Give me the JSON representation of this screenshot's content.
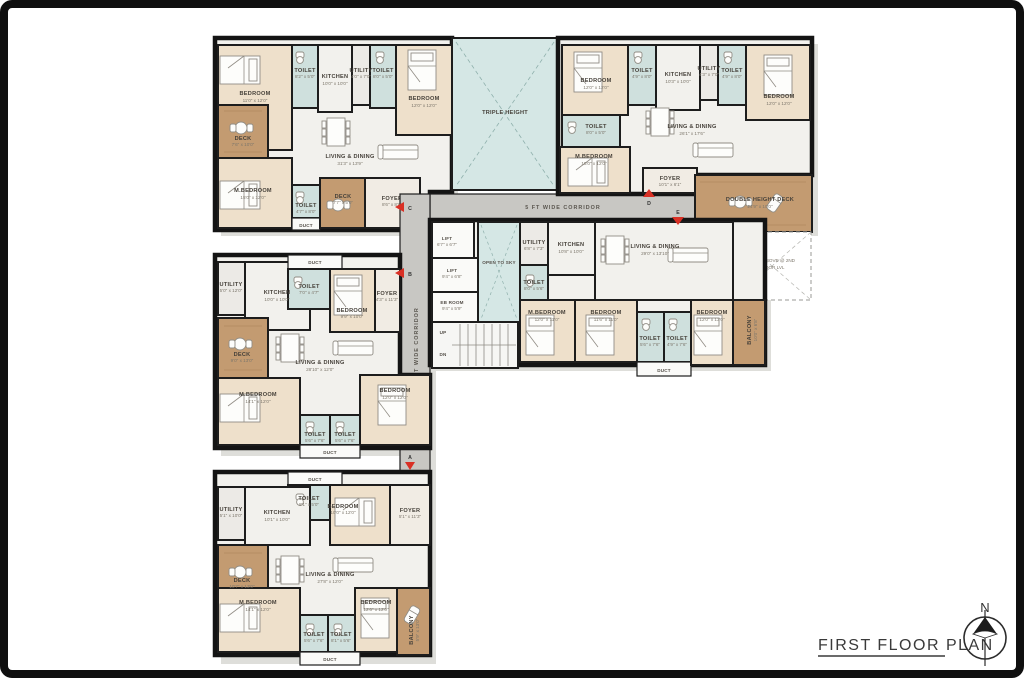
{
  "footer": {
    "title": "FIRST FLOOR PLAN",
    "north": "N"
  },
  "markers": {
    "a": "A",
    "b": "B",
    "c": "C",
    "d": "D",
    "e": "E"
  },
  "core": {
    "corridor": "5 FT WIDE CORRIDOR",
    "triple_height": "TRIPLE HEIGHT",
    "open_to_sky": "OPEN TO SKY",
    "up": "UP",
    "dn": "DN",
    "lift1": {
      "n": "LIFT",
      "d": "6'7\" x 6'7\""
    },
    "lift2": {
      "n": "LIFT",
      "d": "9'4\" x 6'8\""
    },
    "eb": {
      "n": "EB ROOM",
      "d": "9'4\" x 5'9\""
    }
  },
  "units": {
    "a": {
      "rooms": {
        "b1": {
          "n": "BEDROOM",
          "d": "11'0\" x 12'0\""
        },
        "t1": {
          "n": "TOILET",
          "d": "8'2\" x 5'0\""
        },
        "k": {
          "n": "KITCHEN",
          "d": "10'0\" x 10'0\""
        },
        "u": {
          "n": "UTILITY",
          "d": "4'0\" x 7'0\""
        },
        "t2": {
          "n": "TOILET",
          "d": "8'0\" x 5'0\""
        },
        "b2": {
          "n": "BEDROOM",
          "d": "12'0\" x 12'0\""
        },
        "dk": {
          "n": "DECK",
          "d": "7'6\" x 10'0\""
        },
        "lv": {
          "n": "LIVING & DINING",
          "d": "31'3\" x 13'9\""
        },
        "mb": {
          "n": "M.BEDROOM",
          "d": "15'0\" x 12'0\""
        },
        "t3": {
          "n": "TOILET",
          "d": "4'7\" x 8'0\""
        },
        "du": {
          "n": "DUCT"
        },
        "dk2": {
          "n": "DECK",
          "d": "7'7\" x 5'0\""
        },
        "fy": {
          "n": "FOYER",
          "d": "8'6\" x 8'6\""
        }
      }
    },
    "b": {
      "rooms": {
        "b1": {
          "n": "BEDROOM",
          "d": "12'0\" x 12'0\""
        },
        "t1": {
          "n": "TOILET",
          "d": "4'9\" x 8'0\""
        },
        "k": {
          "n": "KITCHEN",
          "d": "10'3\" x 10'0\""
        },
        "u": {
          "n": "UTILITY",
          "d": "4'3\" x 7'0\""
        },
        "t2": {
          "n": "TOILET",
          "d": "4'9\" x 8'0\""
        },
        "b2": {
          "n": "BEDROOM",
          "d": "12'0\" x 12'0\""
        },
        "t3": {
          "n": "TOILET",
          "d": "8'0\" x 5'0\""
        },
        "mb": {
          "n": "M.BEDROOM",
          "d": "15'0\" x 12'0\""
        },
        "lv": {
          "n": "LIVING & DINING",
          "d": "26'1\" x 17'6\""
        },
        "fy": {
          "n": "FOYER",
          "d": "10'1\" x 6'1\""
        },
        "dhd": {
          "n": "DOUBLE HEIGHT DECK",
          "d": "24'9\" x 10'0\""
        },
        "da_l1": "DECK ABOVE @ 2ND",
        "da_l2": "FLOOR LVL"
      }
    },
    "c": {
      "rooms": {
        "u": {
          "n": "UTILITY",
          "d": "6'8\" x 7'3\""
        },
        "k": {
          "n": "KITCHEN",
          "d": "10'8\" x 10'0\""
        },
        "t1": {
          "n": "TOILET",
          "d": "8'0\" x 5'6\""
        },
        "lv": {
          "n": "LIVING & DINING",
          "d": "29'0\" x 13'10\""
        },
        "mb": {
          "n": "M.BEDROOM",
          "d": "12'0\" x 11'0\""
        },
        "b1": {
          "n": "BEDROOM",
          "d": "11'6\" x 11'0\""
        },
        "t2": {
          "n": "TOILET",
          "d": "5'6\" x 7'6\""
        },
        "t3": {
          "n": "TOILET",
          "d": "4'9\" x 7'6\""
        },
        "du": {
          "n": "DUCT"
        },
        "b2": {
          "n": "BEDROOM",
          "d": "12'0\" x 13'0\""
        },
        "bal": {
          "n": "BALCONY",
          "d": "10'0\" x 6'8\""
        }
      }
    },
    "d": {
      "rooms": {
        "u": {
          "n": "UTILITY",
          "d": "5'0\" x 12'0\""
        },
        "k": {
          "n": "KITCHEN",
          "d": "10'0\" x 10'0\""
        },
        "du1": {
          "n": "DUCT"
        },
        "t1": {
          "n": "TOILET",
          "d": "7'0\" x 4'7\""
        },
        "b1": {
          "n": "BEDROOM",
          "d": "9'9\" x 10'0\""
        },
        "fy": {
          "n": "FOYER",
          "d": "4'3\" x 11'3\""
        },
        "dk": {
          "n": "DECK",
          "d": "9'0\" x 13'0\""
        },
        "lv": {
          "n": "LIVING & DINING",
          "d": "28'10\" x 12'0\""
        },
        "mb": {
          "n": "M.BEDROOM",
          "d": "14'1\" x 12'0\""
        },
        "t2": {
          "n": "TOILET",
          "d": "5'6\" x 7'6\""
        },
        "t3": {
          "n": "TOILET",
          "d": "5'6\" x 7'6\""
        },
        "b2": {
          "n": "BEDROOM",
          "d": "12'0\" x 12'0\""
        },
        "du2": {
          "n": "DUCT"
        }
      }
    },
    "e": {
      "rooms": {
        "du1": {
          "n": "DUCT"
        },
        "t1": {
          "n": "TOILET",
          "d": "8'1\" x 5'0\""
        },
        "u": {
          "n": "UTILITY",
          "d": "5'1\" x 10'0\""
        },
        "k": {
          "n": "KITCHEN",
          "d": "10'1\" x 10'0\""
        },
        "b1": {
          "n": "BEDROOM",
          "d": "10'0\" x 12'0\""
        },
        "fy": {
          "n": "FOYER",
          "d": "5'1\" x 11'3\""
        },
        "dk": {
          "n": "DECK",
          "d": "10'7\" x 13'0\""
        },
        "lv": {
          "n": "LIVING & DINING",
          "d": "27'8\" x 12'0\""
        },
        "mb": {
          "n": "M.BEDROOM",
          "d": "14'1\" x 12'0\""
        },
        "t2": {
          "n": "TOILET",
          "d": "5'6\" x 7'6\""
        },
        "t3": {
          "n": "TOILET",
          "d": "8'1\" x 5'6\""
        },
        "b2": {
          "n": "BEDROOM",
          "d": "12'6\" x 12'0\""
        },
        "bal": {
          "n": "BALCONY",
          "d": "5'9\" x 13'0\""
        },
        "du2": {
          "n": "DUCT"
        }
      }
    },
    "colors": {
      "wall": "#141414",
      "bedroom": "#eee0cb",
      "toilet": "#cfe0dd",
      "deck_wood": "#c39b71",
      "corridor": "#c8c7c3",
      "void_teal": "#d5e7e5",
      "marker_red": "#d93025"
    }
  }
}
